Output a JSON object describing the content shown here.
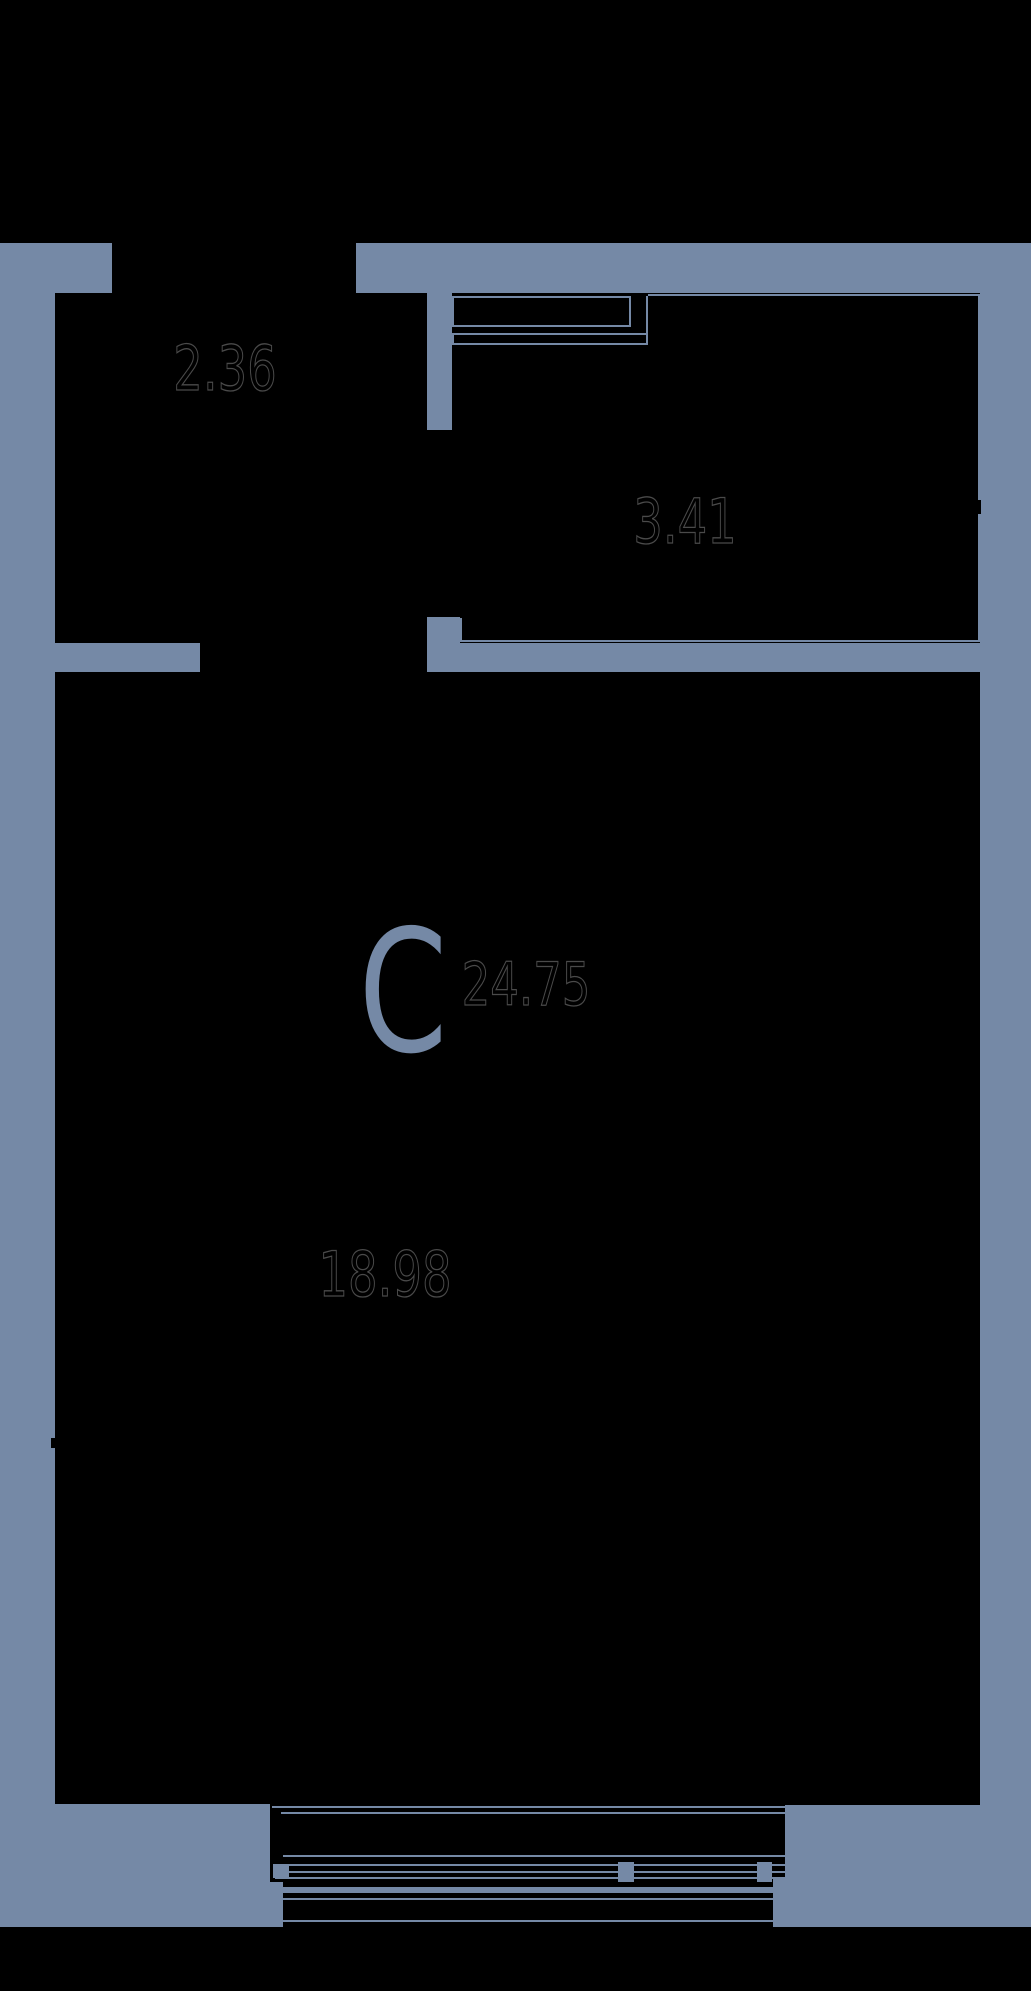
{
  "colors": {
    "wall": "#7589A6",
    "background": "#000000",
    "area_ink": "#4A4A4A"
  },
  "unit": {
    "type_letter": "С",
    "total_area": "24.75",
    "rooms": {
      "hallway": {
        "area": "2.36"
      },
      "washroom": {
        "area": "3.41"
      },
      "living_room": {
        "area": "18.98"
      }
    }
  }
}
